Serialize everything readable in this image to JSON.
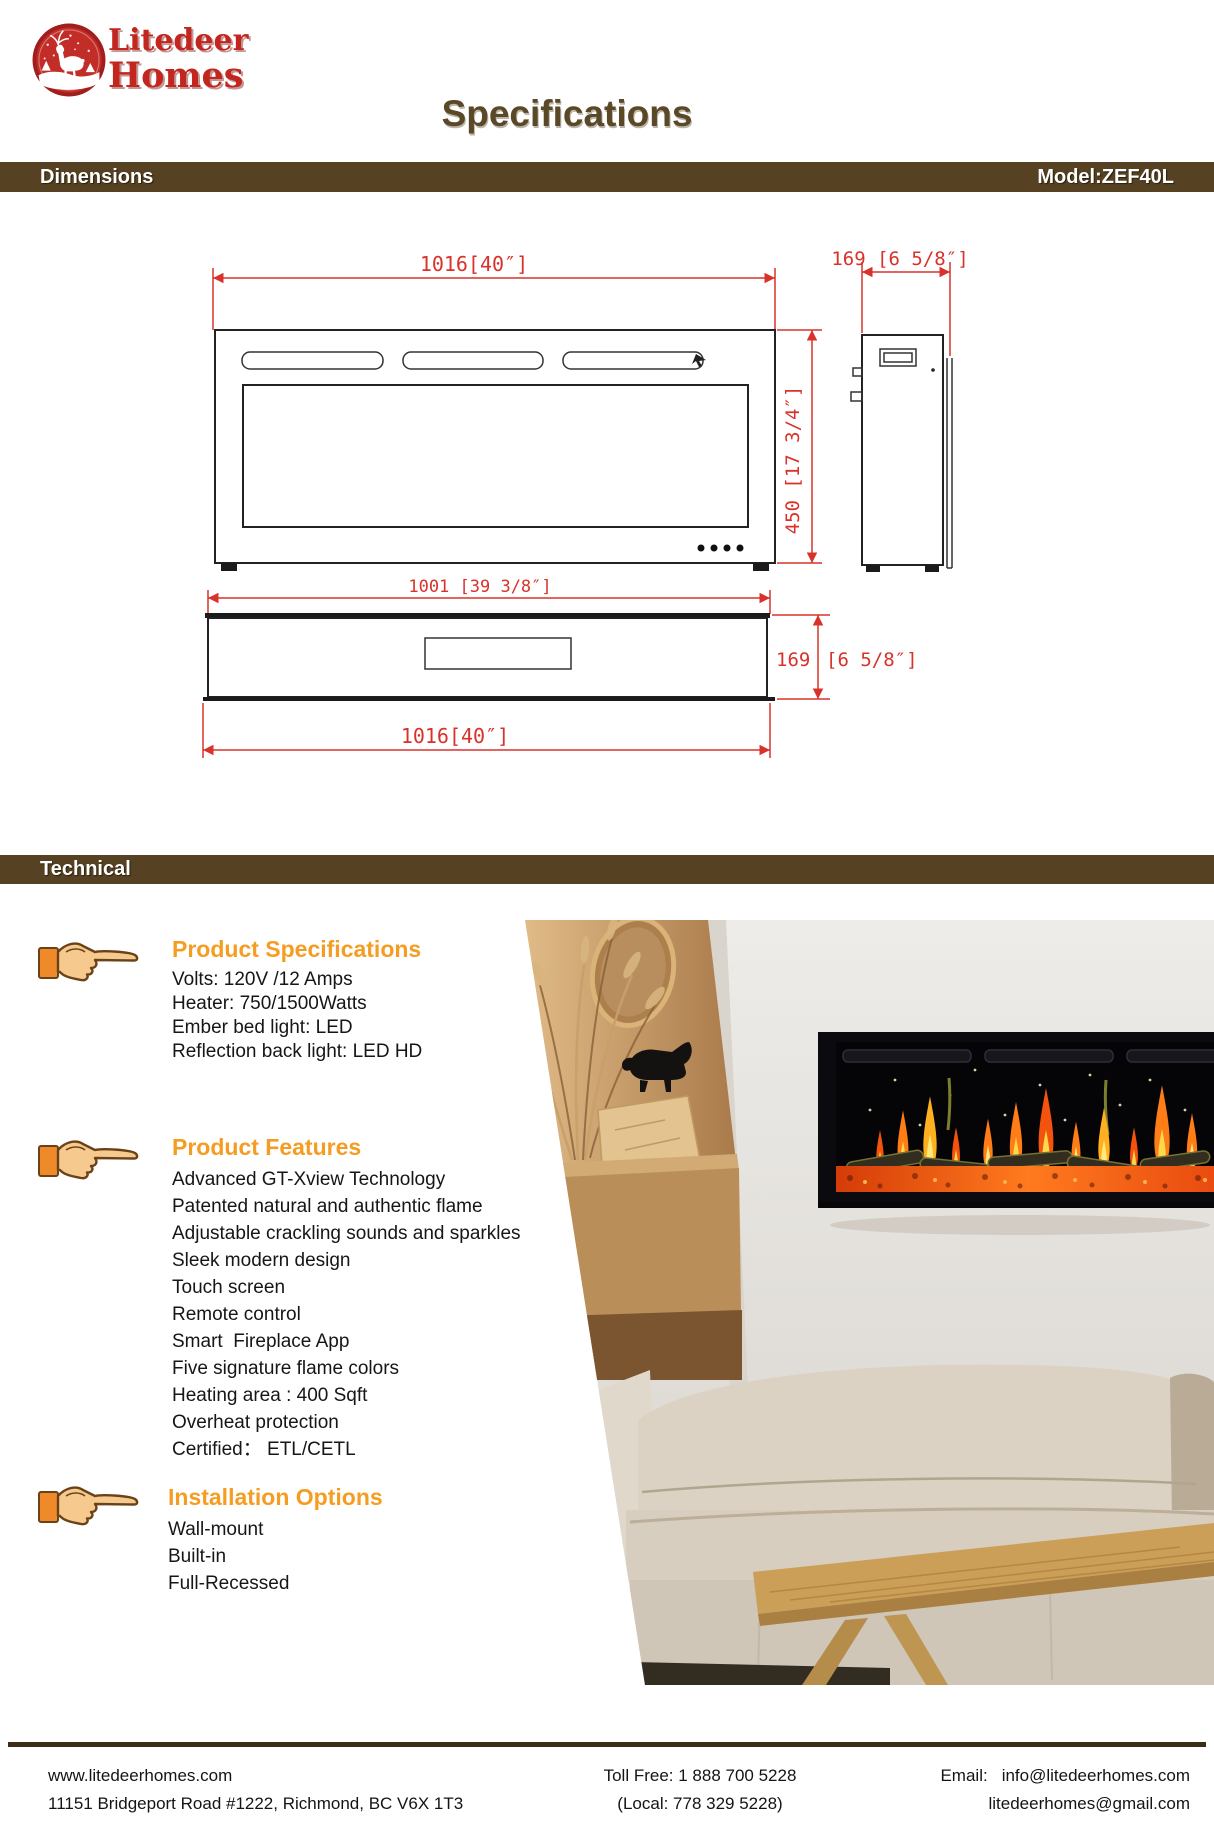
{
  "logo": {
    "line1": "Litedeer",
    "line2": "Homes",
    "badge_icon": "deer-in-snow-badge-icon"
  },
  "title": "Specifications",
  "bars": {
    "dimensions": "Dimensions",
    "model": "Model:ZEF40L",
    "technical": "Technical"
  },
  "drawing": {
    "dim_front_width": "1016[40″]",
    "dim_side_depth": "169 [6 5/8″]",
    "dim_front_height": "450 [17 3/4″]",
    "dim_bottom_inner_width": "1001 [39 3/8″]",
    "dim_bottom_depth_value": "169",
    "dim_bottom_depth_bracket": "[6 5/8″]",
    "dim_bottom_width": "1016[40″]"
  },
  "sections": [
    {
      "title": "Product Specifications",
      "icon": "pointing-hand-icon",
      "items": [
        "Volts: 120V /12 Amps",
        "Heater: 750/1500Watts",
        "Ember bed light: LED",
        "Reflection back light: LED HD"
      ]
    },
    {
      "title": "Product Features",
      "icon": "pointing-hand-icon",
      "items": [
        "Advanced GT-Xview Technology",
        "Patented natural and authentic flame",
        "Adjustable crackling sounds and sparkles",
        "Sleek modern design",
        "Touch screen",
        "Remote control",
        "Smart  Fireplace App",
        "Five signature flame colors",
        "Heating area : 400 Sqft",
        "Overheat protection",
        "Certified： ETL/CETL"
      ]
    },
    {
      "title": "Installation Options",
      "icon": "pointing-hand-icon",
      "items": [
        "Wall-mount",
        "Built-in",
        "Full-Recessed"
      ]
    }
  ],
  "photo": {
    "description": "lifestyle-photo-fireplace-living-room"
  },
  "footer": {
    "website": "www.litedeerhomes.com",
    "address": "11151 Bridgeport Road #1222, Richmond, BC V6X 1T3",
    "toll_free": "Toll Free: 1 888 700 5228",
    "local": "(Local: 778 329 5228)",
    "email_label": "Email:",
    "email1": "info@litedeerhomes.com",
    "email2": "litedeerhomes@gmail.com"
  },
  "theme": {
    "accent_orange": "#f59d22",
    "bar_brown": "#564222",
    "title_brown": "#5a4826",
    "logo_red": "#c3251f",
    "drawing_red": "#d8322a",
    "text_dark": "#161616"
  }
}
